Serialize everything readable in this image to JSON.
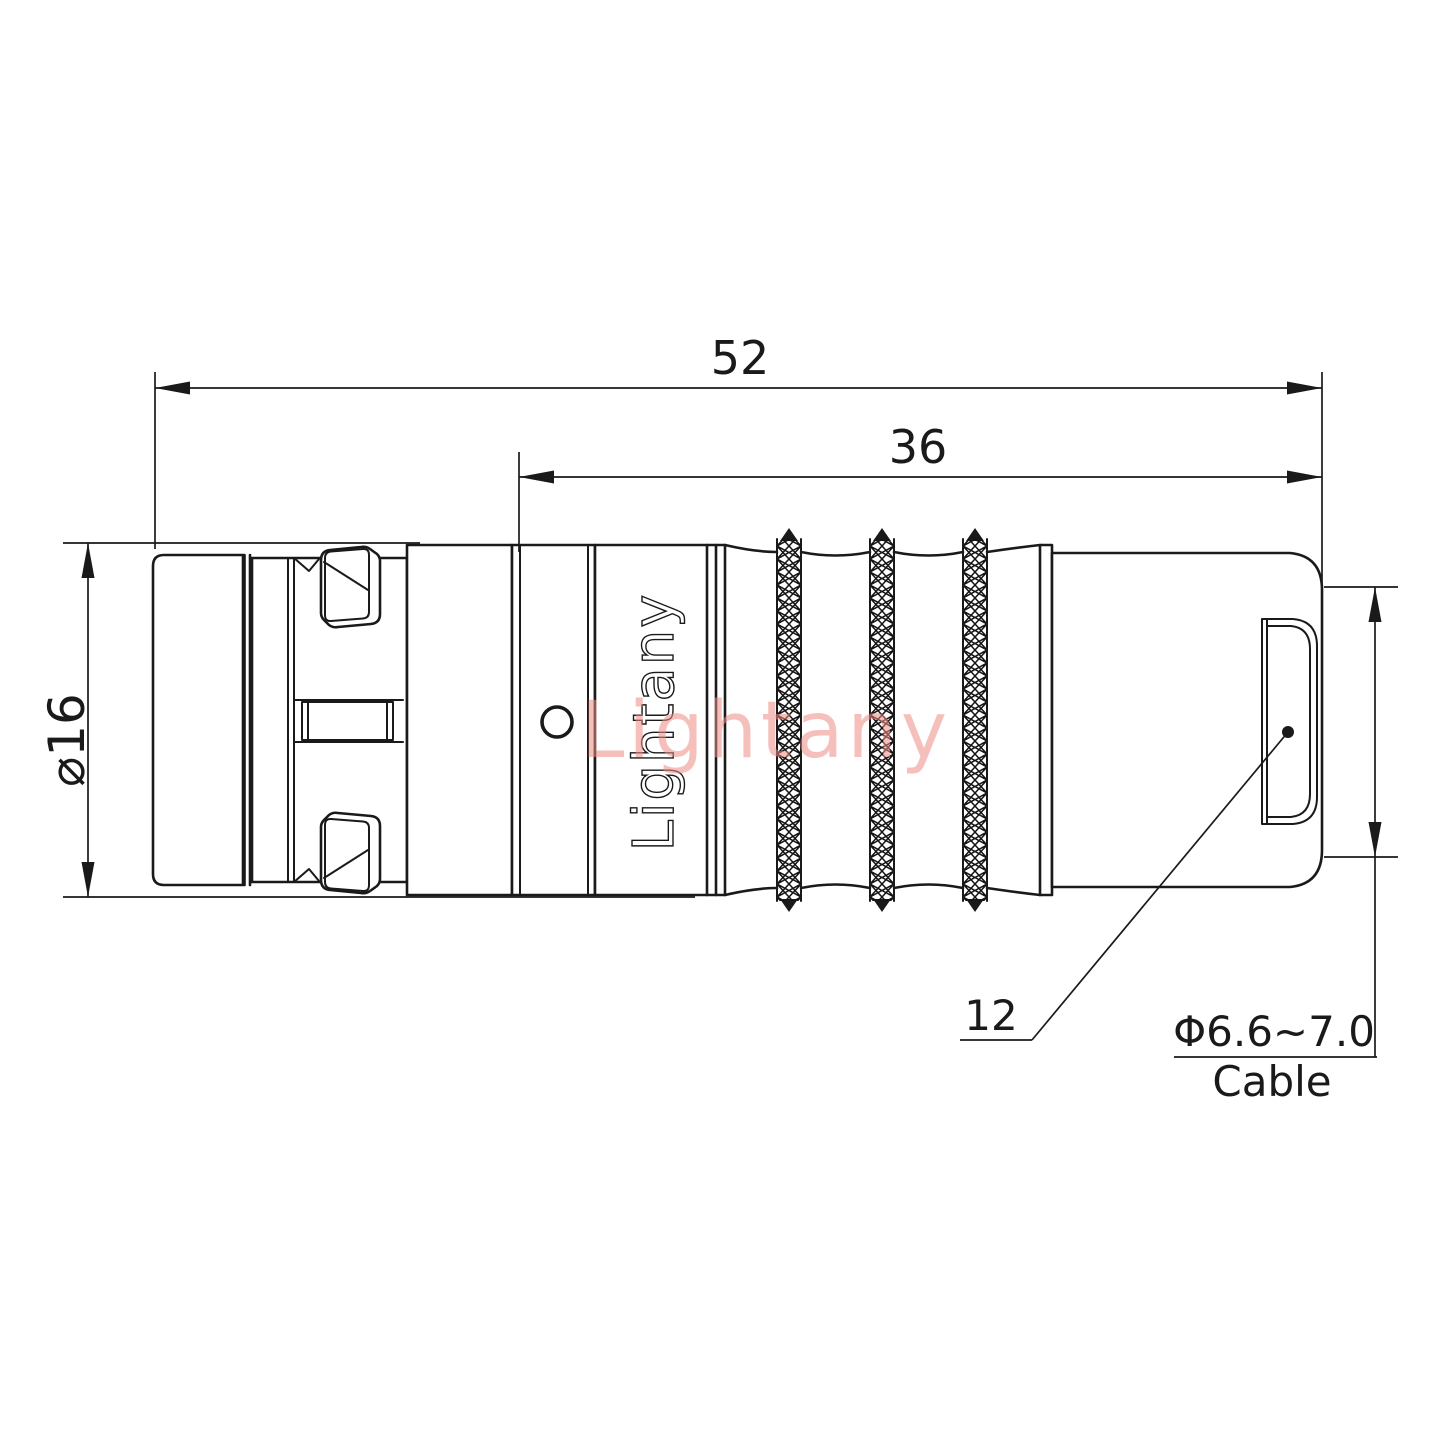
{
  "colors": {
    "background": "#ffffff",
    "line": "#1a1a1a",
    "watermark": "#ee8d85"
  },
  "watermark": {
    "text": "Lightany"
  },
  "connector": {
    "brand_label": "Lightany"
  },
  "dimensions": {
    "overall_length": "52",
    "rear_length": "36",
    "body_diameter": "⌀16",
    "backnut": "12",
    "cable_diameter_range": "Φ6.6~7.0",
    "cable_label": "Cable"
  }
}
